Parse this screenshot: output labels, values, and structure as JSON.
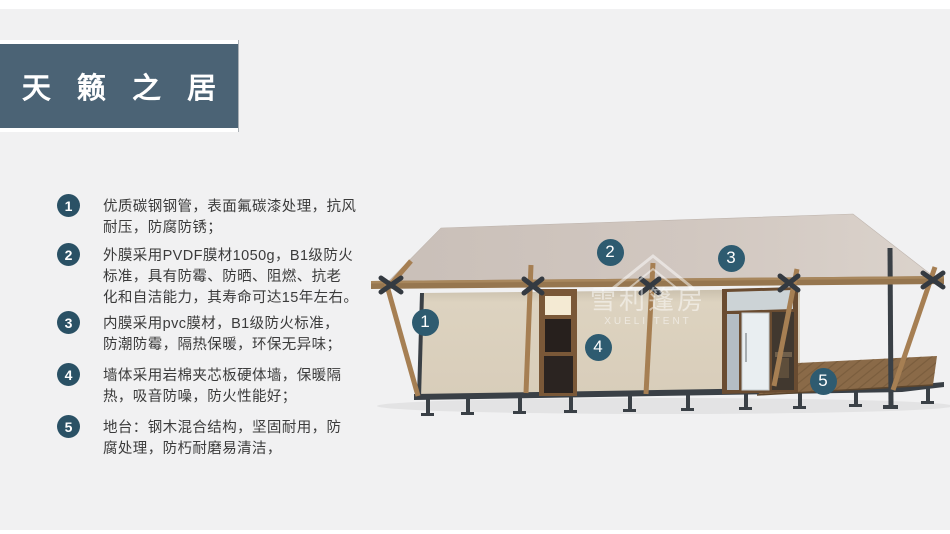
{
  "header": {
    "title": "天 籁 之 居"
  },
  "features": [
    {
      "number": "1",
      "lines": [
        "优质碳钢钢管，表面氟碳漆处理，抗风",
        "耐压，防腐防锈；"
      ]
    },
    {
      "number": "2",
      "lines": [
        "外膜采用PVDF膜材1050g，B1级防火",
        "标准，具有防霉、防晒、阻燃、抗老",
        "化和自洁能力，其寿命可达15年左右。"
      ]
    },
    {
      "number": "3",
      "lines": [
        "内膜采用pvc膜材，B1级防火标准，",
        "防潮防霉，隔热保暖，环保无异味；"
      ]
    },
    {
      "number": "4",
      "lines": [
        "墙体采用岩棉夹芯板硬体墙，保暖隔",
        "热，吸音防噪，防火性能好；"
      ]
    },
    {
      "number": "5",
      "lines": [
        "地台：钢木混合结构，坚固耐用，防",
        "腐处理，防朽耐磨易清洁，"
      ]
    }
  ],
  "callouts": [
    {
      "number": "1",
      "x": 425,
      "y": 322
    },
    {
      "number": "2",
      "x": 610,
      "y": 252
    },
    {
      "number": "3",
      "x": 731,
      "y": 258
    },
    {
      "number": "4",
      "x": 598,
      "y": 347
    },
    {
      "number": "5",
      "x": 823,
      "y": 381
    }
  ],
  "illustration": {
    "watermark": {
      "cn": "雪利篷房",
      "en": "XUELI TENT"
    }
  },
  "colors": {
    "banner_bg": "#4b6375",
    "badge_bg": "#2a5165",
    "callout_bg": "#2e5b70",
    "roof": "#d0c6bf",
    "wall": "#dcd2bf",
    "wood": "#a67f53",
    "steel": "#3a4046",
    "deck": "#8a6a48"
  }
}
